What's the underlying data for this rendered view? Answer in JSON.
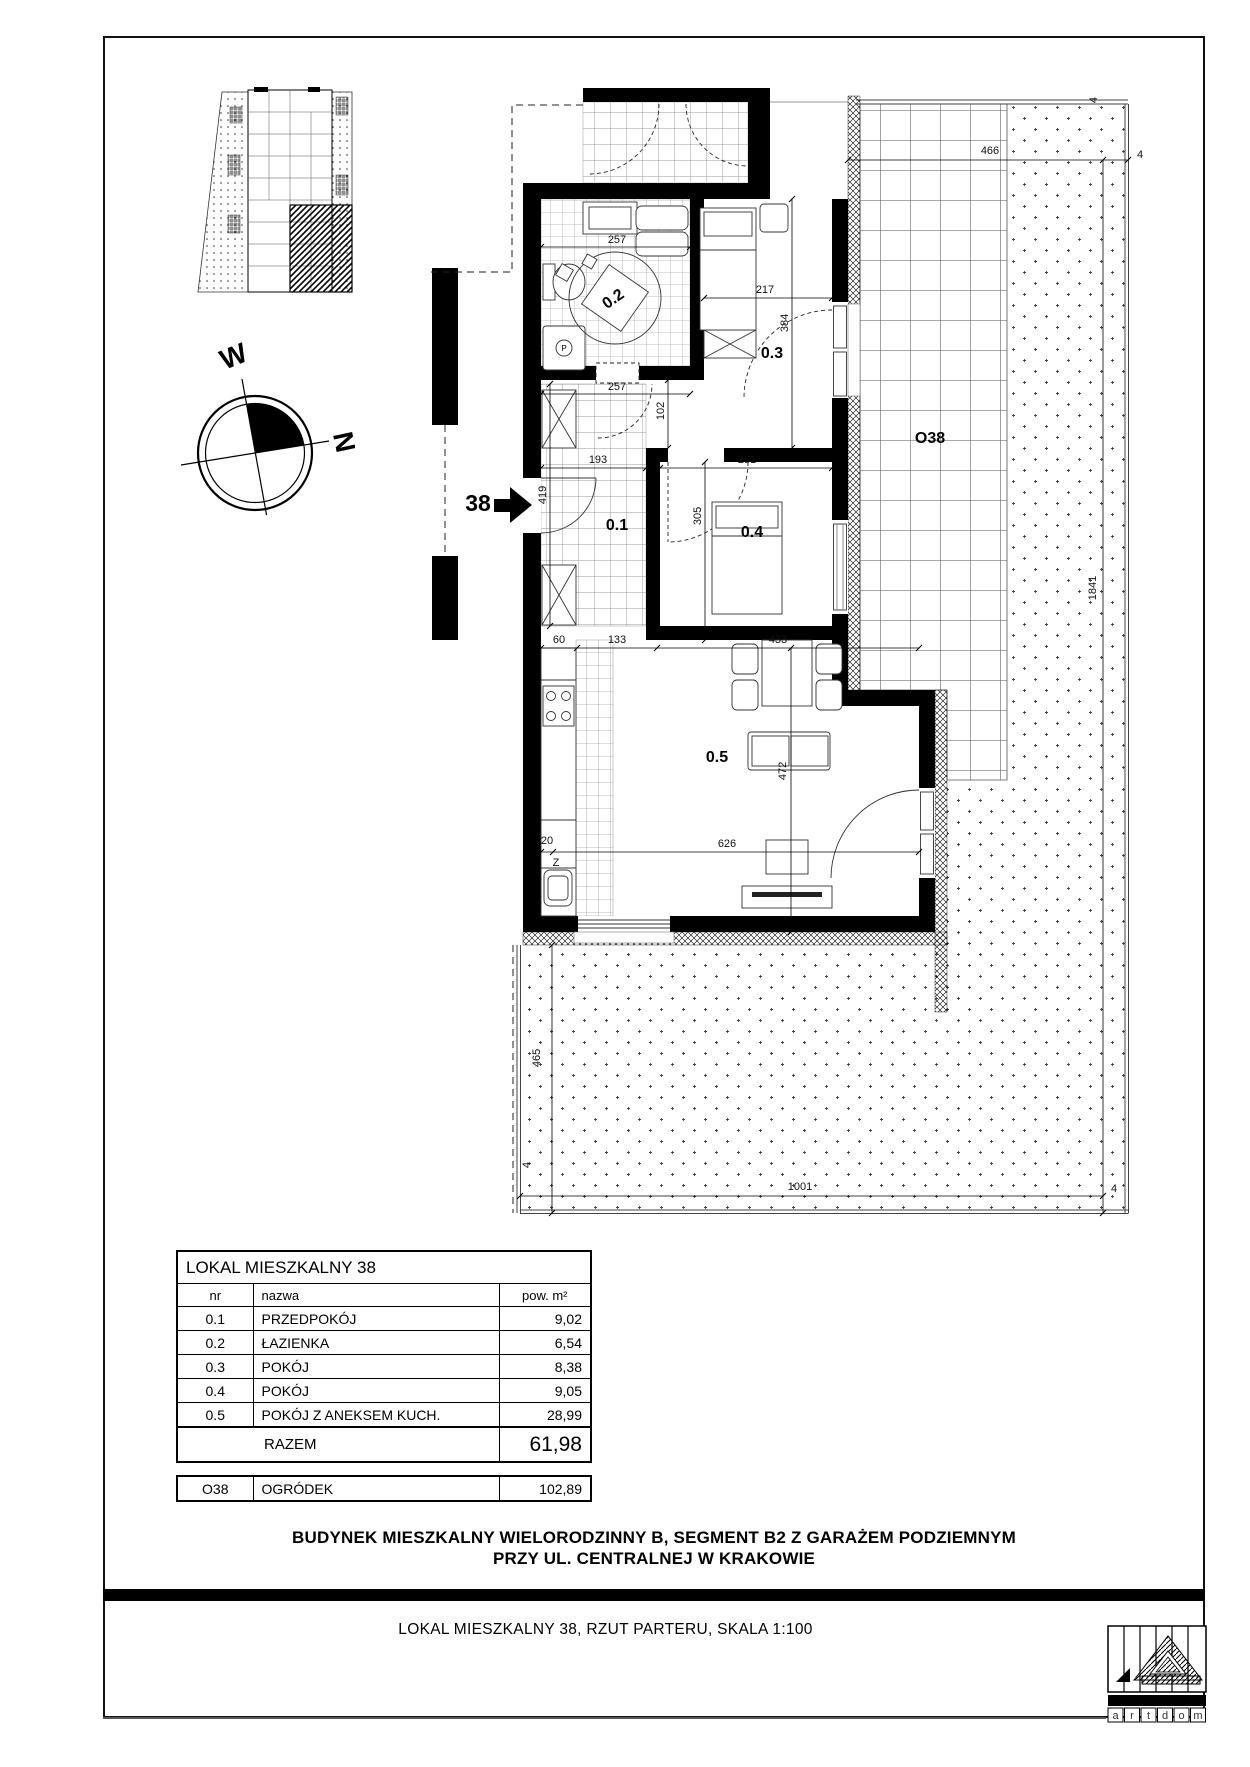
{
  "sheet": {
    "project_title_line1": "BUDYNEK MIESZKALNY WIELORODZINNY B, SEGMENT B2 Z GARAŻEM PODZIEMNYM",
    "project_title_line2": "PRZY UL. CENTRALNEJ W KRAKOWIE",
    "drawing_title": "LOKAL MIESZKALNY 38, RZUT PARTERU, SKALA 1:100"
  },
  "compass": {
    "west": "W",
    "north": "N"
  },
  "plan": {
    "entrance_number": "38",
    "garden_label": "O38",
    "marks": {
      "washer": "P",
      "sink": "Z"
    },
    "rooms": {
      "hall": "0.1",
      "bath": "0.2",
      "room3": "0.3",
      "room4": "0.4",
      "living": "0.5"
    },
    "dims": {
      "w257a": "257",
      "w257b": "257",
      "w217": "217",
      "w384": "384",
      "w102": "102",
      "w193": "193",
      "w281": "281",
      "w305": "305",
      "w419": "419",
      "w60": "60",
      "w133": "133",
      "w433": "433",
      "w472": "472",
      "w626": "626",
      "w20": "20",
      "w466": "466",
      "w1841": "1841",
      "w1001": "1001",
      "w465": "465",
      "w4": "4"
    }
  },
  "area_table": {
    "title": "LOKAL MIESZKALNY 38",
    "col_nr": "nr",
    "col_name": "nazwa",
    "col_area": "pow. m²",
    "rows": [
      {
        "nr": "0.1",
        "name": "PRZEDPOKÓJ",
        "area": "9,02"
      },
      {
        "nr": "0.2",
        "name": "ŁAZIENKA",
        "area": "6,54"
      },
      {
        "nr": "0.3",
        "name": "POKÓJ",
        "area": "8,38"
      },
      {
        "nr": "0.4",
        "name": "POKÓJ",
        "area": "9,05"
      },
      {
        "nr": "0.5",
        "name": "POKÓJ Z ANEKSEM KUCH.",
        "area": "28,99"
      }
    ],
    "total_label": "RAZEM",
    "total_value": "61,98"
  },
  "garden_table": {
    "nr": "O38",
    "name": "OGRÓDEK",
    "area": "102,89"
  },
  "logo": {
    "letters": [
      "a",
      "r",
      "t",
      "d",
      "o",
      "m"
    ]
  }
}
